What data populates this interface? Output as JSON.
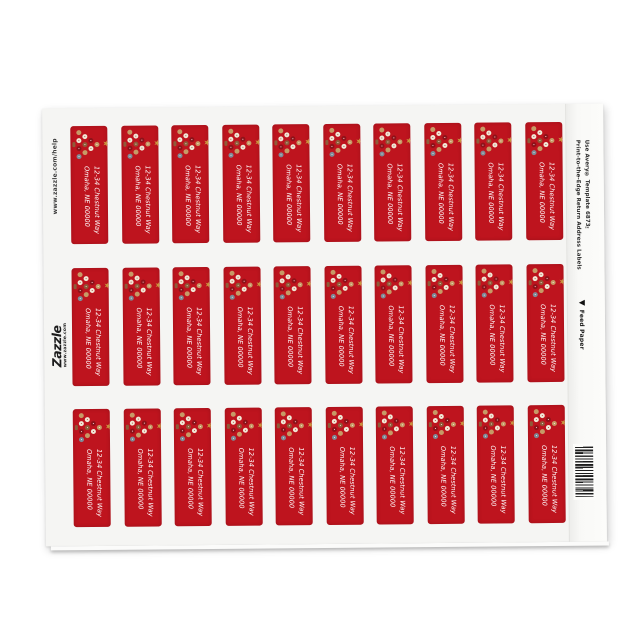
{
  "page": {
    "background_color": "#ffffff",
    "description": "Zazzle product mockup: sheet of holiday return address labels"
  },
  "sheet": {
    "background_color": "#f5f5f3",
    "help_url": "www.zazzle.com/help",
    "logo": {
      "name": "Zazzle",
      "tagline": "www.zazzle.com"
    },
    "product_info_line1": "Print-to-the-Edge Return Address Labels",
    "product_info_line2": "Use Avery® Template 6873™",
    "feed_paper_label": "Feed Paper",
    "grid": {
      "columns": 10,
      "rows": 3,
      "total_labels": 30
    }
  },
  "label": {
    "background_color": "#be141e",
    "text_color": "#ffffff",
    "address_line1": "12-34 Chestnut Way",
    "address_line2": "Omaha, NE 00000",
    "graphic": "christmas-tree-of-ornaments",
    "ornament_colors": {
      "cream": "#f0e8d6",
      "tan": "#c79a66",
      "brown": "#8f5b39",
      "slate": "#7f8b97",
      "darkred": "#8e1219",
      "gold": "#c9953f"
    }
  },
  "icons": {
    "tree_topper": "star-icon",
    "feed_arrow": "left-triangle-icon",
    "barcode": "vertical-barcode"
  }
}
